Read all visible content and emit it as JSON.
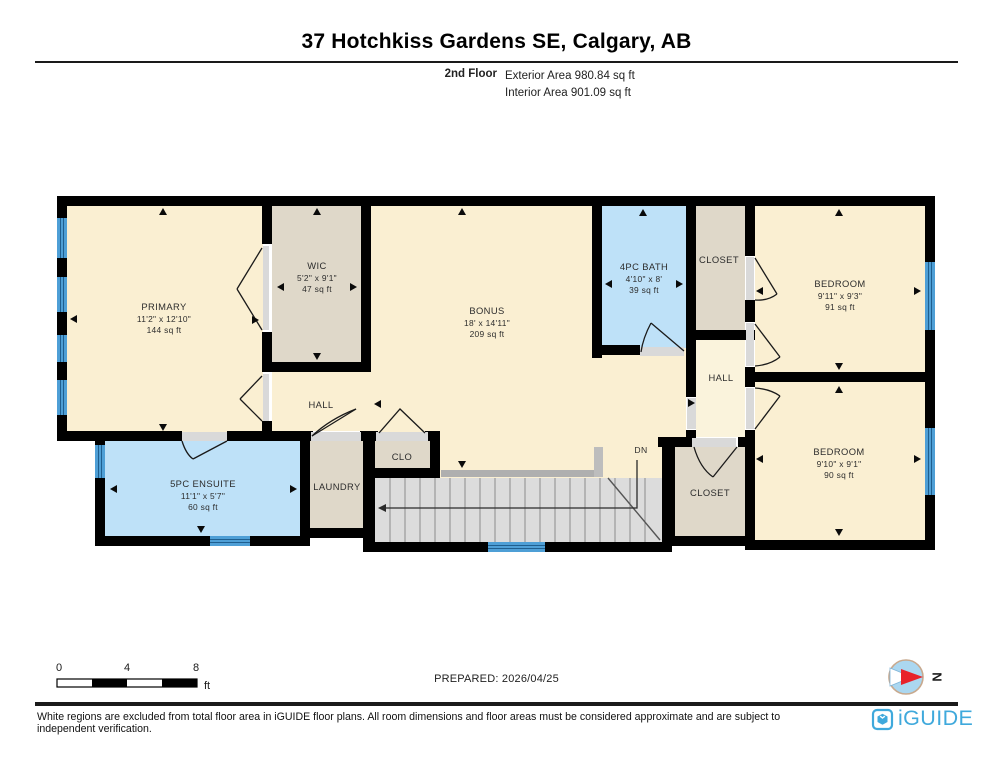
{
  "header": {
    "title": "37 Hotchkiss Gardens SE, Calgary, AB",
    "floor_label": "2nd Floor",
    "exterior_area": "Exterior Area 980.84 sq ft",
    "interior_area": "Interior Area 901.09 sq ft"
  },
  "rooms": {
    "primary": {
      "name": "PRIMARY",
      "dims": "11'2\" x 12'10\"",
      "area": "144 sq ft"
    },
    "wic": {
      "name": "WIC",
      "dims": "5'2\" x 9'1\"",
      "area": "47 sq ft"
    },
    "bonus": {
      "name": "BONUS",
      "dims": "18' x 14'11\"",
      "area": "209 sq ft"
    },
    "bath": {
      "name": "4PC BATH",
      "dims": "4'10\" x 8'",
      "area": "39 sq ft"
    },
    "closet_top": {
      "name": "CLOSET"
    },
    "hall_left": {
      "name": "HALL"
    },
    "hall_right": {
      "name": "HALL"
    },
    "bedroom_top": {
      "name": "BEDROOM",
      "dims": "9'11\" x 9'3\"",
      "area": "91 sq ft"
    },
    "bedroom_bottom": {
      "name": "BEDROOM",
      "dims": "9'10\" x 9'1\"",
      "area": "90 sq ft"
    },
    "ensuite": {
      "name": "5PC ENSUITE",
      "dims": "11'1\" x 5'7\"",
      "area": "60 sq ft"
    },
    "laundry": {
      "name": "LAUNDRY"
    },
    "clo": {
      "name": "CLO"
    },
    "closet_bottom": {
      "name": "CLOSET"
    },
    "stairs": {
      "label": "DN"
    }
  },
  "scale_bar": {
    "tick_0": "0",
    "tick_4": "4",
    "tick_8": "8",
    "unit": "ft"
  },
  "prepared_label": "PREPARED: 2026/04/25",
  "compass": {
    "north_label": "N"
  },
  "footer": {
    "disclaimer": "White regions are excluded from total floor area in iGUIDE floor plans. All room dimensions and floor areas must be considered approximate and are subject to independent verification.",
    "brand": "iGUIDE"
  },
  "colors": {
    "room_cream": "#FAEFD2",
    "closet_taupe": "#DFD8C9",
    "wet_room_blue": "#BEE1F8",
    "window_blue": "#4E9FD6",
    "wall_black": "#000000",
    "stairs_gray": "#DCDCDC",
    "door_gray": "#D9D9D9",
    "brand_blue": "#3FA9DC",
    "compass_red": "#E8222A"
  }
}
